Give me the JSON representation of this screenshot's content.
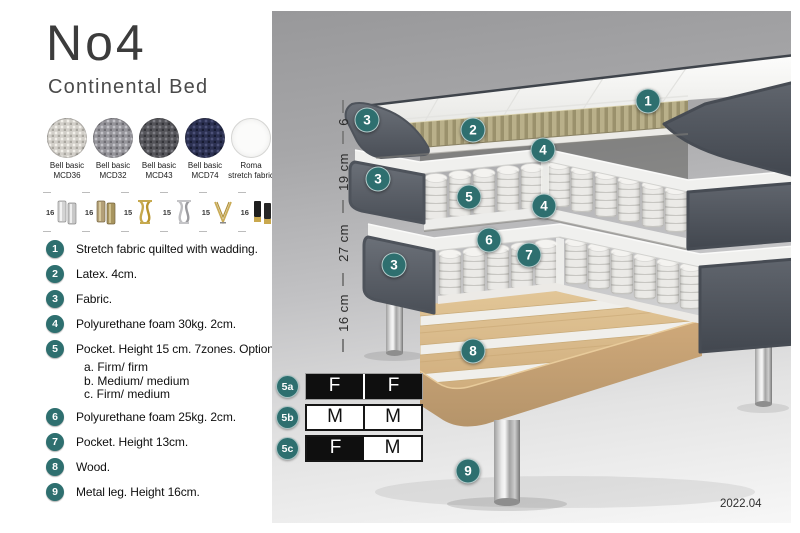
{
  "header": {
    "title": "No4",
    "subtitle": "Continental Bed"
  },
  "fabrics": [
    {
      "name": "Bell basic",
      "code": "MCD36"
    },
    {
      "name": "Bell basic",
      "code": "MCD32"
    },
    {
      "name": "Bell basic",
      "code": "MCD43"
    },
    {
      "name": "Bell basic",
      "code": "MCD74"
    },
    {
      "name": "Roma",
      "code": "stretch fabric"
    }
  ],
  "legs": [
    {
      "size": "16",
      "type": "cylinder-silver"
    },
    {
      "size": "16",
      "type": "cylinder-bronze"
    },
    {
      "size": "15",
      "type": "twisted-gold"
    },
    {
      "size": "15",
      "type": "twisted-silver"
    },
    {
      "size": "15",
      "type": "hairpin-gold"
    },
    {
      "size": "16",
      "type": "cylinder-black-gold-tip"
    }
  ],
  "parts": [
    {
      "num": "1",
      "text": "Stretch fabric quilted with wadding."
    },
    {
      "num": "2",
      "text": "Latex. 4cm."
    },
    {
      "num": "3",
      "text": "Fabric."
    },
    {
      "num": "4",
      "text": "Polyurethane foam 30kg. 2cm."
    },
    {
      "num": "5",
      "text": "Pocket. Height 15 cm. 7zones. Option:",
      "options": [
        "a. Firm/ firm",
        "b. Medium/ medium",
        "c. Firm/ medium"
      ]
    },
    {
      "num": "6",
      "text": "Polyurethane foam 25kg. 2cm."
    },
    {
      "num": "7",
      "text": "Pocket. Height 13cm."
    },
    {
      "num": "8",
      "text": "Wood."
    },
    {
      "num": "9",
      "text": "Metal leg. Height 16cm."
    }
  ],
  "diagram": {
    "measurements": [
      "6",
      "19 cm",
      "27 cm",
      "16 cm"
    ],
    "callouts": [
      "1",
      "2",
      "3",
      "3",
      "3",
      "4",
      "4",
      "5",
      "6",
      "7",
      "8",
      "9"
    ],
    "version": "2022.04"
  },
  "firmness": [
    {
      "label": "5a",
      "cells": [
        "F",
        "F"
      ]
    },
    {
      "label": "5b",
      "cells": [
        "M",
        "M"
      ]
    },
    {
      "label": "5c",
      "cells": [
        "F",
        "M"
      ]
    }
  ],
  "colors": {
    "badge_teal": "#2e6f6f",
    "firmness_dark": "#0f0f0f",
    "fabric_dark_gray": "#565b63",
    "latex_khaki": "#b1a87f",
    "wood": "#d7b88a"
  }
}
